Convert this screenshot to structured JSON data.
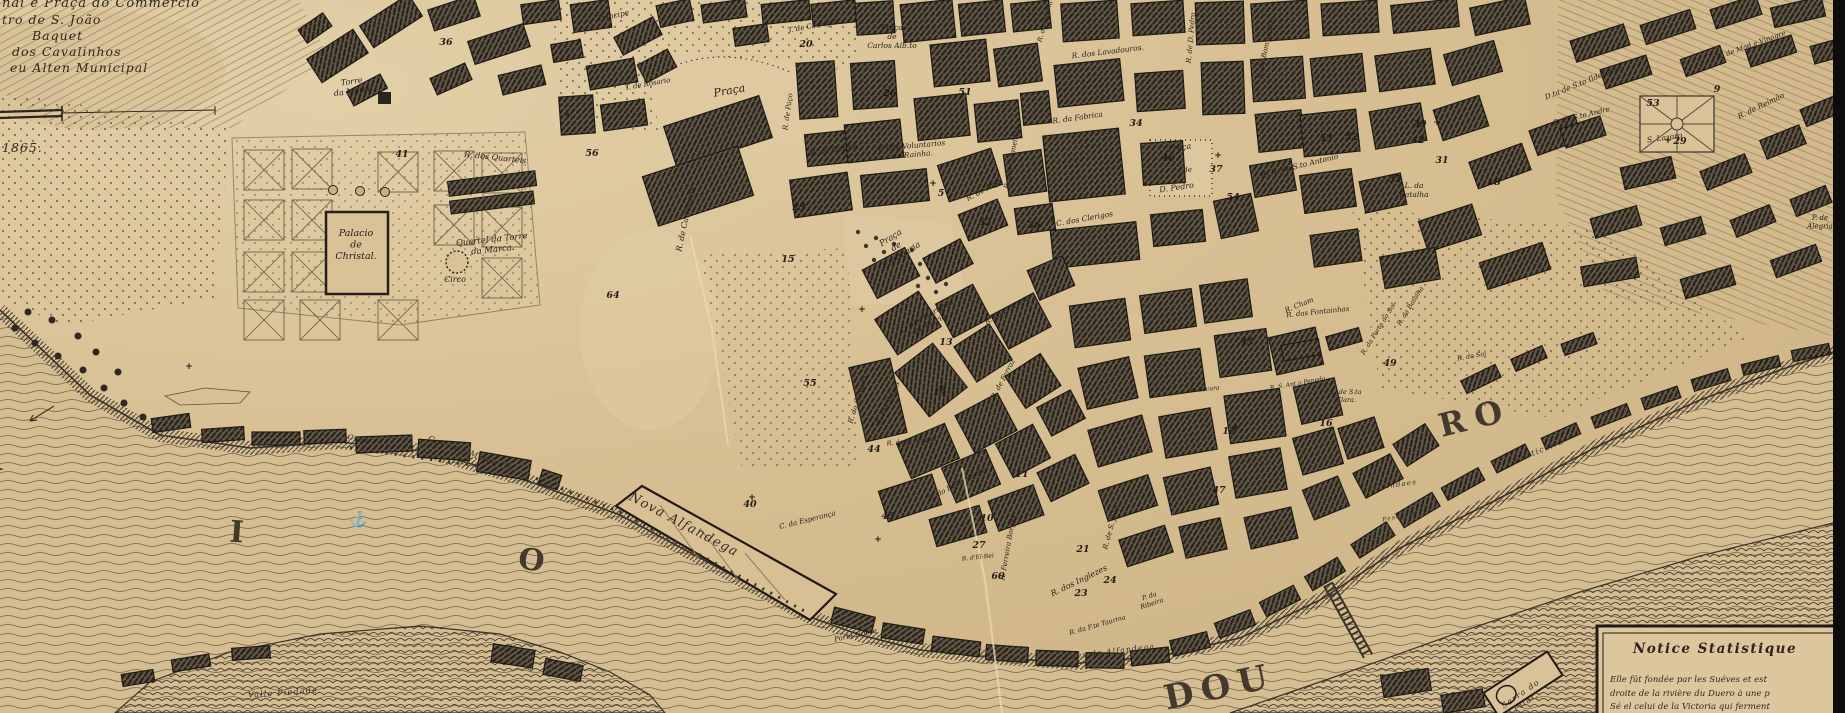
{
  "map": {
    "legend": {
      "lines": [
        {
          "text": "nal e Praça do Commercio",
          "x": 2,
          "y": 7,
          "size": 13
        },
        {
          "text": "tro de S. João",
          "x": 2,
          "y": 24,
          "size": 12.5
        },
        {
          "text": "Baquet",
          "x": 32,
          "y": 40,
          "size": 12.5
        },
        {
          "text": "dos Cavalinhos",
          "x": 12,
          "y": 56,
          "size": 12.5
        },
        {
          "text": "eu Alten Municipal",
          "x": 10,
          "y": 72,
          "size": 12.5
        }
      ],
      "year": "1865."
    },
    "notice": {
      "title": "Notice Statistique",
      "lines": [
        "Elle fût fondée par les Suéves et est",
        "droite de la rivière du Duero à une p",
        "Sé el celui de la Victoria qui ferment"
      ]
    },
    "river_letters": [
      {
        "text": "R",
        "x": -10,
        "y": 470,
        "rot": 0,
        "size": 30,
        "ls": 0
      },
      {
        "text": "I",
        "x": 236,
        "y": 542,
        "rot": 4,
        "size": 30,
        "ls": 0
      },
      {
        "text": "O",
        "x": 530,
        "y": 570,
        "rot": 8,
        "size": 30,
        "ls": 0
      },
      {
        "text": "DOU",
        "x": 1222,
        "y": 698,
        "rot": -12,
        "size": 34,
        "ls": 8
      },
      {
        "text": "RO",
        "x": 1478,
        "y": 428,
        "rot": -14,
        "size": 32,
        "ls": 10
      }
    ],
    "anchor_icon": "⚓",
    "labels": [
      {
        "text": "Torre\nda Marca",
        "x": 352,
        "y": 84,
        "rot": -8,
        "size": 8
      },
      {
        "text": "Palacio\nde\nChristal.",
        "x": 356,
        "y": 236,
        "rot": 0,
        "size": 9.5
      },
      {
        "text": "Quartel da Torre\nda Marca.",
        "x": 492,
        "y": 242,
        "rot": -6,
        "size": 8.5
      },
      {
        "text": "Circo",
        "x": 455,
        "y": 282,
        "rot": 0,
        "size": 8
      },
      {
        "text": "R.  dos  Quarteis",
        "x": 495,
        "y": 160,
        "rot": 6,
        "size": 8
      },
      {
        "text": "R. de Carrancas",
        "x": 688,
        "y": 220,
        "rot": -78,
        "size": 8
      },
      {
        "text": "Praça",
        "x": 730,
        "y": 94,
        "rot": -10,
        "size": 11
      },
      {
        "text": "Principe",
        "x": 614,
        "y": 18,
        "rot": -12,
        "size": 7.5
      },
      {
        "text": "T. de Carregal.",
        "x": 814,
        "y": 28,
        "rot": -10,
        "size": 7
      },
      {
        "text": "T. de Rosario",
        "x": 648,
        "y": 86,
        "rot": -10,
        "size": 7
      },
      {
        "text": "R. de Paço",
        "x": 790,
        "y": 112,
        "rot": -82,
        "size": 7
      },
      {
        "text": "R. de Carme",
        "x": 834,
        "y": 152,
        "rot": -8,
        "size": 7.5
      },
      {
        "text": "P. dos Voluntarios\nda Rainha.",
        "x": 912,
        "y": 148,
        "rot": -5,
        "size": 7.5
      },
      {
        "text": "Praça\nde\nCarlos Alb.to",
        "x": 892,
        "y": 30,
        "rot": 0,
        "size": 7.5
      },
      {
        "text": "R. dos Lavadouros.",
        "x": 1108,
        "y": 54,
        "rot": -7,
        "size": 7.5
      },
      {
        "text": "R. da Fabrica",
        "x": 1078,
        "y": 120,
        "rot": -8,
        "size": 7.5
      },
      {
        "text": "R. dos Carmelitas",
        "x": 1014,
        "y": 158,
        "rot": -80,
        "size": 7
      },
      {
        "text": "R. de Anjo",
        "x": 985,
        "y": 192,
        "rot": -28,
        "size": 7.5
      },
      {
        "text": "C. dos Clerigos",
        "x": 1085,
        "y": 221,
        "rot": -10,
        "size": 7.5
      },
      {
        "text": "Praça",
        "x": 1180,
        "y": 150,
        "rot": -8,
        "size": 8
      },
      {
        "text": "de",
        "x": 1188,
        "y": 172,
        "rot": -8,
        "size": 7
      },
      {
        "text": "D. Pedro",
        "x": 1177,
        "y": 190,
        "rot": -8,
        "size": 8
      },
      {
        "text": "R. de D. Pedro",
        "x": 1193,
        "y": 38,
        "rot": -85,
        "size": 7
      },
      {
        "text": "R. do Bom Jardim",
        "x": 1268,
        "y": 48,
        "rot": -78,
        "size": 7
      },
      {
        "text": "R. da Picaria",
        "x": 1047,
        "y": 22,
        "rot": -75,
        "size": 6.5
      },
      {
        "text": "R. N. de S.to Antonio",
        "x": 1300,
        "y": 168,
        "rot": -14,
        "size": 7.5
      },
      {
        "text": "L. da\nBatalha",
        "x": 1414,
        "y": 188,
        "rot": 0,
        "size": 7.5
      },
      {
        "text": "D.ta de S.to Ildefonso.",
        "x": 1585,
        "y": 84,
        "rot": -22,
        "size": 7.5
      },
      {
        "text": "R. de S.to Andre",
        "x": 1582,
        "y": 118,
        "rot": -14,
        "size": 7
      },
      {
        "text": "R. de Mad.e Vinagre",
        "x": 1752,
        "y": 47,
        "rot": -20,
        "size": 7
      },
      {
        "text": "R. de Reimão",
        "x": 1762,
        "y": 108,
        "rot": -26,
        "size": 7.5
      },
      {
        "text": "S. Lazaro",
        "x": 1665,
        "y": 140,
        "rot": -8,
        "size": 7.5
      },
      {
        "text": "Praça\nde\nCordoaria",
        "x": 892,
        "y": 240,
        "rot": -32,
        "size": 8.5
      },
      {
        "text": "L. dos Martyres\nda Patria.",
        "x": 928,
        "y": 318,
        "rot": -30,
        "size": 7.5
      },
      {
        "text": "R. do Calvario",
        "x": 860,
        "y": 400,
        "rot": -72,
        "size": 7
      },
      {
        "text": "R. das Taipas",
        "x": 890,
        "y": 404,
        "rot": -65,
        "size": 7
      },
      {
        "text": "R. da Ferraria",
        "x": 1008,
        "y": 312,
        "rot": -30,
        "size": 7
      },
      {
        "text": "R. de Ferraz",
        "x": 1005,
        "y": 380,
        "rot": -62,
        "size": 7
      },
      {
        "text": "R. de S. Miguel",
        "x": 912,
        "y": 443,
        "rot": -6,
        "size": 6.5
      },
      {
        "text": "R. do Bello Monte",
        "x": 958,
        "y": 486,
        "rot": -28,
        "size": 7
      },
      {
        "text": "C. da Esperança",
        "x": 808,
        "y": 522,
        "rot": -14,
        "size": 7
      },
      {
        "text": "Porta Nobre",
        "x": 856,
        "y": 637,
        "rot": -12,
        "size": 7
      },
      {
        "text": "Nova  Alfandega",
        "x": 682,
        "y": 528,
        "rot": 28,
        "size": 13,
        "style": "script"
      },
      {
        "text": "Caes de Miragaia",
        "x": 470,
        "y": 456,
        "rot": 20,
        "size": 8,
        "style": "script"
      },
      {
        "text": "Caes",
        "x": 358,
        "y": 441,
        "rot": 12,
        "size": 7,
        "style": "script"
      },
      {
        "text": "Caes da Alfandega",
        "x": 1110,
        "y": 654,
        "rot": -7,
        "size": 7.5,
        "style": "script"
      },
      {
        "text": "R. da F.te Taurina",
        "x": 1098,
        "y": 627,
        "rot": -16,
        "size": 6.5
      },
      {
        "text": "R. dos Inglezes",
        "x": 1080,
        "y": 583,
        "rot": -26,
        "size": 8
      },
      {
        "text": "R. de S. João",
        "x": 1113,
        "y": 528,
        "rot": -75,
        "size": 7
      },
      {
        "text": "R. Ferreira Borges",
        "x": 1010,
        "y": 548,
        "rot": -80,
        "size": 7
      },
      {
        "text": "P. da\nRibeira",
        "x": 1150,
        "y": 598,
        "rot": -18,
        "size": 6.5
      },
      {
        "text": "R. d'El-Rei",
        "x": 978,
        "y": 559,
        "rot": -6,
        "size": 6
      },
      {
        "text": "Guindaes",
        "x": 1396,
        "y": 487,
        "rot": -8,
        "size": 7,
        "style": "script"
      },
      {
        "text": "Corticeira",
        "x": 1540,
        "y": 453,
        "rot": -22,
        "size": 8,
        "style": "script"
      },
      {
        "text": "L. de S.ta\nClara.",
        "x": 1346,
        "y": 394,
        "rot": 0,
        "size": 6.5
      },
      {
        "text": "R. Cham",
        "x": 1300,
        "y": 307,
        "rot": -22,
        "size": 7
      },
      {
        "text": "R. da Porta do Sol",
        "x": 1380,
        "y": 330,
        "rot": -58,
        "size": 6.5
      },
      {
        "text": "R. de Sol",
        "x": 1472,
        "y": 358,
        "rot": -10,
        "size": 6.5
      },
      {
        "text": "R. da Batalha",
        "x": 1412,
        "y": 307,
        "rot": -58,
        "size": 6.5
      },
      {
        "text": "R. das Fontainhas",
        "x": 1318,
        "y": 314,
        "rot": -6,
        "size": 7
      },
      {
        "text": "P. de\nAlegria",
        "x": 1820,
        "y": 220,
        "rot": 0,
        "size": 7
      },
      {
        "text": "R. Escura",
        "x": 1205,
        "y": 391,
        "rot": -6,
        "size": 6
      },
      {
        "text": "R. S. Ant.o Penedo",
        "x": 1298,
        "y": 385,
        "rot": -10,
        "size": 6
      },
      {
        "text": "Pescaria",
        "x": 1400,
        "y": 518,
        "rot": -12,
        "size": 6,
        "style": "script"
      },
      {
        "text": "Valle Piedade.",
        "x": 285,
        "y": 695,
        "rot": -4,
        "size": 8,
        "style": "script"
      },
      {
        "text": "Serra do\nPilar.",
        "x": 1522,
        "y": 696,
        "rot": -35,
        "size": 8,
        "style": "script"
      }
    ],
    "numbers": [
      {
        "text": "41",
        "x": 402,
        "y": 157
      },
      {
        "text": "36",
        "x": 446,
        "y": 45
      },
      {
        "text": "56",
        "x": 592,
        "y": 156
      },
      {
        "text": "20",
        "x": 806,
        "y": 47
      },
      {
        "text": "26",
        "x": 890,
        "y": 96
      },
      {
        "text": "51",
        "x": 965,
        "y": 95
      },
      {
        "text": "46",
        "x": 1168,
        "y": 161
      },
      {
        "text": "34",
        "x": 1136,
        "y": 126
      },
      {
        "text": "37",
        "x": 1216,
        "y": 172
      },
      {
        "text": "52",
        "x": 985,
        "y": 225
      },
      {
        "text": "36",
        "x": 1034,
        "y": 228
      },
      {
        "text": "5",
        "x": 941,
        "y": 196
      },
      {
        "text": "23",
        "x": 799,
        "y": 210
      },
      {
        "text": "15",
        "x": 788,
        "y": 262
      },
      {
        "text": "13",
        "x": 946,
        "y": 345
      },
      {
        "text": "14",
        "x": 940,
        "y": 395
      },
      {
        "text": "55",
        "x": 810,
        "y": 386
      },
      {
        "text": "44",
        "x": 874,
        "y": 452
      },
      {
        "text": "43",
        "x": 888,
        "y": 519
      },
      {
        "text": "40",
        "x": 750,
        "y": 507
      },
      {
        "text": "47",
        "x": 1219,
        "y": 493
      },
      {
        "text": "27",
        "x": 979,
        "y": 548
      },
      {
        "text": "60",
        "x": 998,
        "y": 579
      },
      {
        "text": "21",
        "x": 1083,
        "y": 552
      },
      {
        "text": "23",
        "x": 1081,
        "y": 596
      },
      {
        "text": "24",
        "x": 1110,
        "y": 583
      },
      {
        "text": "49",
        "x": 1390,
        "y": 366
      },
      {
        "text": "16",
        "x": 1326,
        "y": 426
      },
      {
        "text": "45",
        "x": 1247,
        "y": 345
      },
      {
        "text": "12",
        "x": 1229,
        "y": 434
      },
      {
        "text": "39",
        "x": 1420,
        "y": 127
      },
      {
        "text": "42",
        "x": 1418,
        "y": 143
      },
      {
        "text": "53",
        "x": 1326,
        "y": 141
      },
      {
        "text": "52",
        "x": 1352,
        "y": 140
      },
      {
        "text": "35",
        "x": 1395,
        "y": 182
      },
      {
        "text": "31",
        "x": 1442,
        "y": 163
      },
      {
        "text": "18",
        "x": 1494,
        "y": 185
      },
      {
        "text": "29",
        "x": 1680,
        "y": 144
      },
      {
        "text": "9",
        "x": 1717,
        "y": 92
      },
      {
        "text": "64",
        "x": 613,
        "y": 298
      },
      {
        "text": "53",
        "x": 1653,
        "y": 106
      },
      {
        "text": "10",
        "x": 987,
        "y": 521
      },
      {
        "text": "11",
        "x": 1022,
        "y": 477
      },
      {
        "text": "54",
        "x": 1233,
        "y": 200
      }
    ]
  }
}
